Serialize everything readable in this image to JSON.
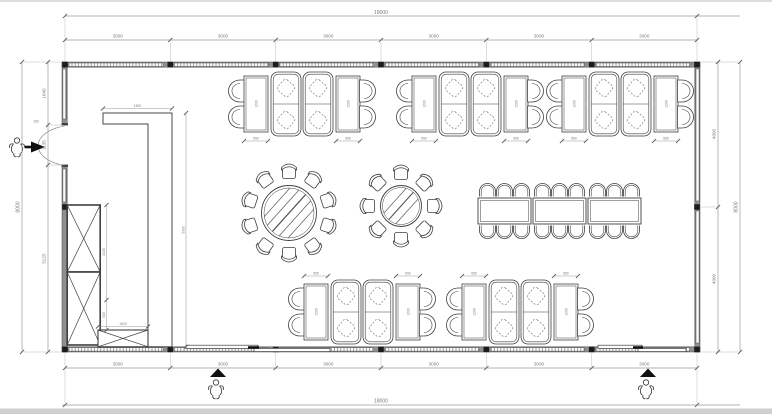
{
  "drawing_type": "restaurant-floor-plan",
  "dimensions": {
    "top": {
      "total": "18000",
      "segments": [
        "3000",
        "3000",
        "3000",
        "3000",
        "3000",
        "3000"
      ]
    },
    "bottom": {
      "total": "18000",
      "segments": [
        "3000",
        "3000",
        "3000",
        "3000",
        "3000",
        "3000"
      ]
    },
    "left": {
      "total": "8000",
      "segments": [
        "1640",
        "1135",
        "5225"
      ]
    },
    "right": {
      "total": "8000",
      "segments": [
        "4000",
        "4000"
      ]
    },
    "interior": {
      "partition_top_width": "1500",
      "partition_height": "5385",
      "cabinet_run_upper": "2425",
      "cabinet_run_lower": "550",
      "low_cabinet_width": "1500",
      "entry_side": "150",
      "booth_table_length": "1200",
      "booth_table_width": "650"
    }
  },
  "icons": {
    "person": "person-figure",
    "entry_arrow": "entry-direction-arrow",
    "door_swing": "door-swing-arc",
    "window": "window-hatch-strip",
    "column": "column-marker"
  },
  "colors": {
    "line": "#3f3f3f",
    "wall": "#8f8f8f",
    "dim_line": "#9a9a9a",
    "background": "#ffffff"
  }
}
